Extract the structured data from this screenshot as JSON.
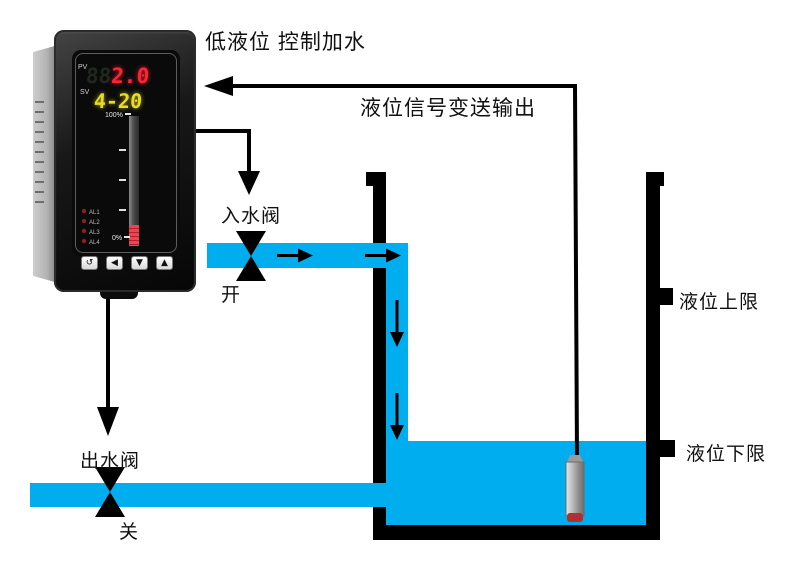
{
  "annotations": {
    "title": "低液位 控制加水",
    "signal_output": "液位信号变送输出",
    "inlet_valve": "入水阀",
    "inlet_valve_state": "开",
    "outlet_valve": "出水阀",
    "outlet_valve_state": "关",
    "upper_limit": "液位上限",
    "lower_limit": "液位下限"
  },
  "device": {
    "pv_label": "PV",
    "pv_ghost": "88",
    "pv_value": "2.0",
    "sv_label": "SV",
    "sv_value": "4-20",
    "bar_top_label": "100%",
    "bar_bottom_label": "0%",
    "leds": [
      "AL1",
      "AL2",
      "AL3",
      "AL4"
    ],
    "buttons": [
      "↺",
      "◀",
      "▼",
      "▲"
    ]
  },
  "colors": {
    "water": "#00AEEF",
    "line": "#000000",
    "pv_color": "#ff2433",
    "sv_color": "#e8dc20",
    "bar_fill": "#e23a42",
    "sensor_tip": "#b03030"
  }
}
